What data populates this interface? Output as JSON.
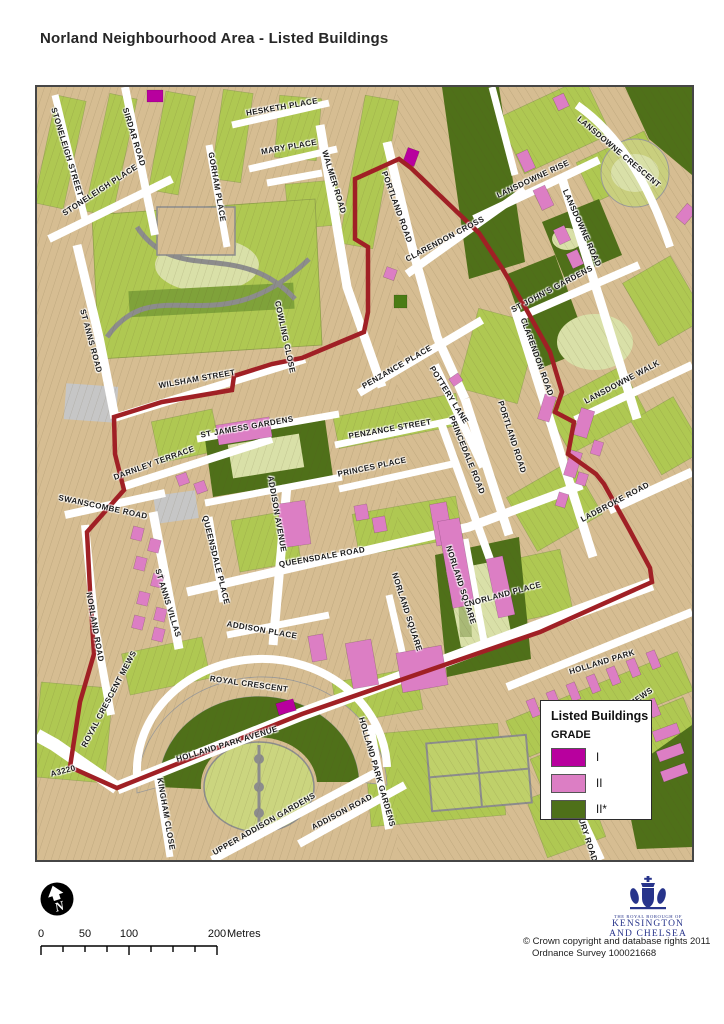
{
  "page": {
    "title": "Norland Neighbourhood Area - Listed Buildings"
  },
  "legend": {
    "title": "Listed Buildings",
    "subtitle": "GRADE",
    "items": [
      {
        "label": "I",
        "color": "#B8009E"
      },
      {
        "label": "II",
        "color": "#DC7EC4"
      },
      {
        "label": "II*",
        "color": "#4E7019"
      }
    ]
  },
  "scale_bar": {
    "labels": [
      "0",
      "50",
      "100",
      "200"
    ],
    "max_metres": 200,
    "unit": "Metres"
  },
  "north_arrow": {
    "letter": "N"
  },
  "attribution": {
    "line1": "© Crown copyright and database rights 2011",
    "line2": "Ordnance Survey 100021668"
  },
  "logo": {
    "line1": "THE ROYAL BOROUGH OF",
    "line2": "KENSINGTON",
    "line3": "AND CHELSEA",
    "color": "#27348B"
  },
  "map": {
    "boundary_color": "#A02025",
    "colors": {
      "building_tan": "#D6BD92",
      "garden_green": "#AFC852",
      "pale_green": "#D9E0A8",
      "communal_olive": "#4F7019",
      "grade1_magenta": "#B8009E",
      "grade2_pink": "#DC7EC4",
      "grade2star_olive": "#4E7019",
      "street_white": "#FFFFFF",
      "path_gray": "#8C8C8C"
    },
    "street_labels": [
      {
        "t": "STONELEIGH STREET",
        "x": 30,
        "y": 65,
        "r": 73
      },
      {
        "t": "SIRDAR ROAD",
        "x": 97,
        "y": 50,
        "r": 73
      },
      {
        "t": "STONELEIGH PLACE",
        "x": 63,
        "y": 103,
        "r": -33
      },
      {
        "t": "HESKETH PLACE",
        "x": 245,
        "y": 20,
        "r": -10
      },
      {
        "t": "MARY PLACE",
        "x": 252,
        "y": 60,
        "r": -10
      },
      {
        "t": "GORHAM PLACE",
        "x": 180,
        "y": 100,
        "r": 80
      },
      {
        "t": "WALMER ROAD",
        "x": 297,
        "y": 95,
        "r": 73
      },
      {
        "t": "PORTLAND ROAD",
        "x": 360,
        "y": 120,
        "r": 70
      },
      {
        "t": "CLARENDON CROSS",
        "x": 408,
        "y": 152,
        "r": -28
      },
      {
        "t": "LANSDOWNE RISE",
        "x": 496,
        "y": 92,
        "r": -25
      },
      {
        "t": "LANSDOWNE CRESCENT",
        "x": 582,
        "y": 65,
        "r": 40
      },
      {
        "t": "LANSDOWNE ROAD",
        "x": 545,
        "y": 141,
        "r": 66
      },
      {
        "t": "ST JOHN'S GARDENS",
        "x": 515,
        "y": 202,
        "r": -28
      },
      {
        "t": "CLARENDON ROAD",
        "x": 500,
        "y": 270,
        "r": 70
      },
      {
        "t": "LANSDOWNE WALK",
        "x": 585,
        "y": 295,
        "r": -28
      },
      {
        "t": "PORTLAND ROAD",
        "x": 475,
        "y": 350,
        "r": 72
      },
      {
        "t": "LADBROKE ROAD",
        "x": 578,
        "y": 415,
        "r": -28
      },
      {
        "t": "ST ANNS ROAD",
        "x": 54,
        "y": 254,
        "r": 75
      },
      {
        "t": "COWLING CLOSE",
        "x": 248,
        "y": 250,
        "r": 78
      },
      {
        "t": "WILSHAM STREET",
        "x": 160,
        "y": 292,
        "r": -10
      },
      {
        "t": "PENZANCE PLACE",
        "x": 360,
        "y": 280,
        "r": -30
      },
      {
        "t": "POTTERY LANE",
        "x": 412,
        "y": 308,
        "r": 58
      },
      {
        "t": "PENZANCE STREET",
        "x": 353,
        "y": 342,
        "r": -10
      },
      {
        "t": "PRINCEDALE ROAD",
        "x": 430,
        "y": 368,
        "r": 68
      },
      {
        "t": "ST JAMESS GARDENS",
        "x": 210,
        "y": 340,
        "r": -10
      },
      {
        "t": "DARNLEY TERRACE",
        "x": 117,
        "y": 376,
        "r": -20
      },
      {
        "t": "PRINCES PLACE",
        "x": 335,
        "y": 380,
        "r": -12
      },
      {
        "t": "ADDISON AVENUE",
        "x": 240,
        "y": 427,
        "r": 80
      },
      {
        "t": "SWANSCOMBE ROAD",
        "x": 66,
        "y": 420,
        "r": 12
      },
      {
        "t": "QUEENSDALE PLACE",
        "x": 179,
        "y": 473,
        "r": 76
      },
      {
        "t": "ST ANNS VILLAS",
        "x": 131,
        "y": 516,
        "r": 73
      },
      {
        "t": "QUEENSDALE ROAD",
        "x": 285,
        "y": 470,
        "r": -10
      },
      {
        "t": "ADDISON PLACE",
        "x": 225,
        "y": 543,
        "r": 10
      },
      {
        "t": "NORLAND SQUARE",
        "x": 370,
        "y": 525,
        "r": 72
      },
      {
        "t": "NORLAND SQUARE",
        "x": 424,
        "y": 498,
        "r": 72
      },
      {
        "t": "NORLAND PLACE",
        "x": 468,
        "y": 507,
        "r": -15
      },
      {
        "t": "ROYAL CRESCENT",
        "x": 212,
        "y": 597,
        "r": 8
      },
      {
        "t": "ROYAL CRESCENT MEWS",
        "x": 72,
        "y": 612,
        "r": -62
      },
      {
        "t": "NORLAND ROAD",
        "x": 58,
        "y": 540,
        "r": 80
      },
      {
        "t": "HOLLAND PARK AVENUE",
        "x": 190,
        "y": 657,
        "r": -17
      },
      {
        "t": "A3220",
        "x": 26,
        "y": 684,
        "r": -15
      },
      {
        "t": "KINGHAM CLOSE",
        "x": 129,
        "y": 727,
        "r": 80
      },
      {
        "t": "UPPER ADDISON GARDENS",
        "x": 227,
        "y": 737,
        "r": -30
      },
      {
        "t": "ADDISON ROAD",
        "x": 305,
        "y": 725,
        "r": -28
      },
      {
        "t": "HOLLAND PARK GARDENS",
        "x": 340,
        "y": 685,
        "r": 74
      },
      {
        "t": "HOLLAND PARK",
        "x": 565,
        "y": 575,
        "r": -17
      },
      {
        "t": "MEWS",
        "x": 604,
        "y": 610,
        "r": -35
      },
      {
        "t": "URY ROAD",
        "x": 551,
        "y": 753,
        "r": 72
      }
    ]
  }
}
